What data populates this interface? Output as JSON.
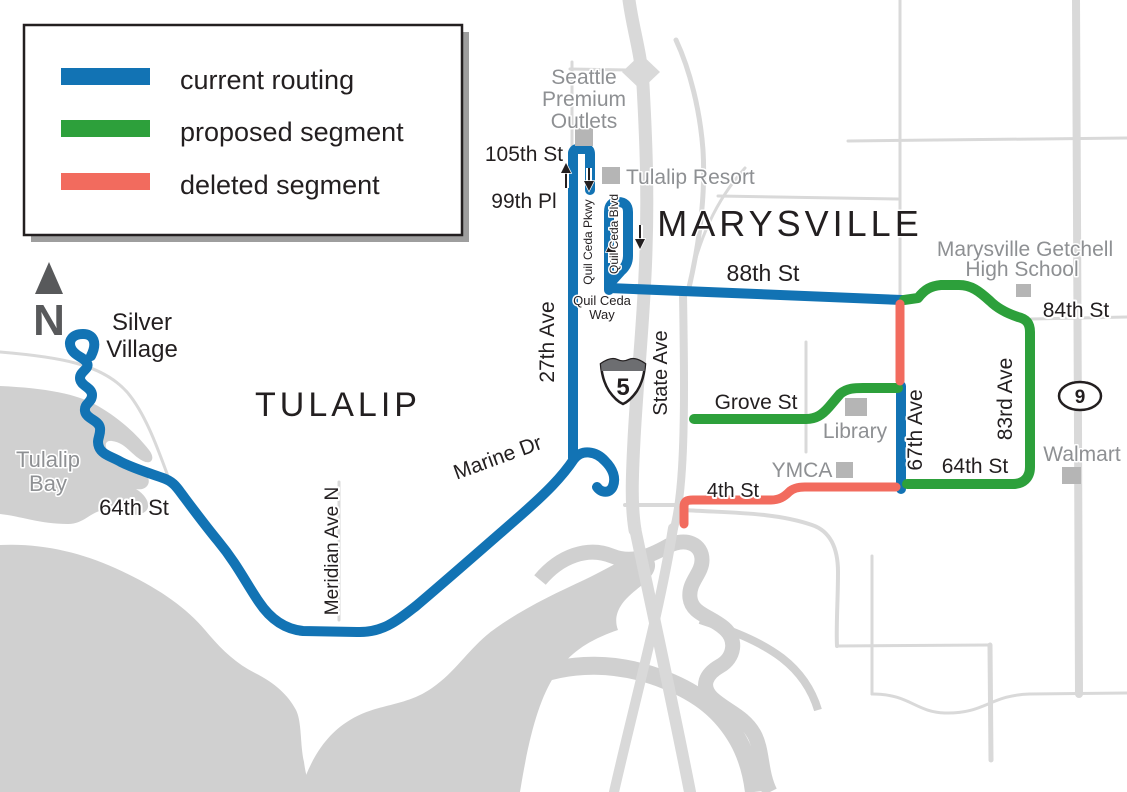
{
  "legend": {
    "items": [
      {
        "id": "current",
        "label": "current routing",
        "color": "#1273b4"
      },
      {
        "id": "proposed",
        "label": "proposed segment",
        "color": "#2da03b"
      },
      {
        "id": "deleted",
        "label": "deleted segment",
        "color": "#f26b5e"
      }
    ]
  },
  "compass": {
    "north_label": "N"
  },
  "regions": {
    "tulalip": "TULALIP",
    "marysville": "MARYSVILLE"
  },
  "shields": {
    "interstate_5": "5",
    "state_route_9": "9"
  },
  "places": {
    "silver_village_line1": "Silver",
    "silver_village_line2": "Village",
    "tulalip_bay_line1": "Tulalip",
    "tulalip_bay_line2": "Bay",
    "seattle_premium_outlets_line1": "Seattle",
    "seattle_premium_outlets_line2": "Premium",
    "seattle_premium_outlets_line3": "Outlets",
    "tulalip_resort": "Tulalip Resort",
    "marysville_getchell_line1": "Marysville Getchell",
    "marysville_getchell_line2": "High School",
    "library": "Library",
    "ymca": "YMCA",
    "walmart": "Walmart"
  },
  "roads": {
    "st_64_west": "64th St",
    "meridian_ave_n": "Meridian Ave N",
    "marine_dr": "Marine Dr",
    "ave_27": "27th Ave",
    "st_105": "105th St",
    "pl_99": "99th Pl",
    "quil_ceda_pkwy": "Quil Ceda Pkwy",
    "quil_ceda_blvd": "Quil Ceda Blvd",
    "quil_ceda_way_line1": "Quil Ceda",
    "quil_ceda_way_line2": "Way",
    "st_88": "88th St",
    "state_ave": "State Ave",
    "st_84": "84th St",
    "ave_83": "83rd Ave",
    "grove_st": "Grove St",
    "ave_67": "67th Ave",
    "st_64_east": "64th St",
    "st_4": "4th St"
  },
  "colors": {
    "current_routing": "#1273b4",
    "proposed_segment": "#2da03b",
    "deleted_segment": "#f26b5e",
    "road": "#d9d9d9",
    "water": "#d0d0d0",
    "building_marker": "#b5b5b5",
    "gray_label": "#8e9093",
    "black_label": "#231f20"
  }
}
